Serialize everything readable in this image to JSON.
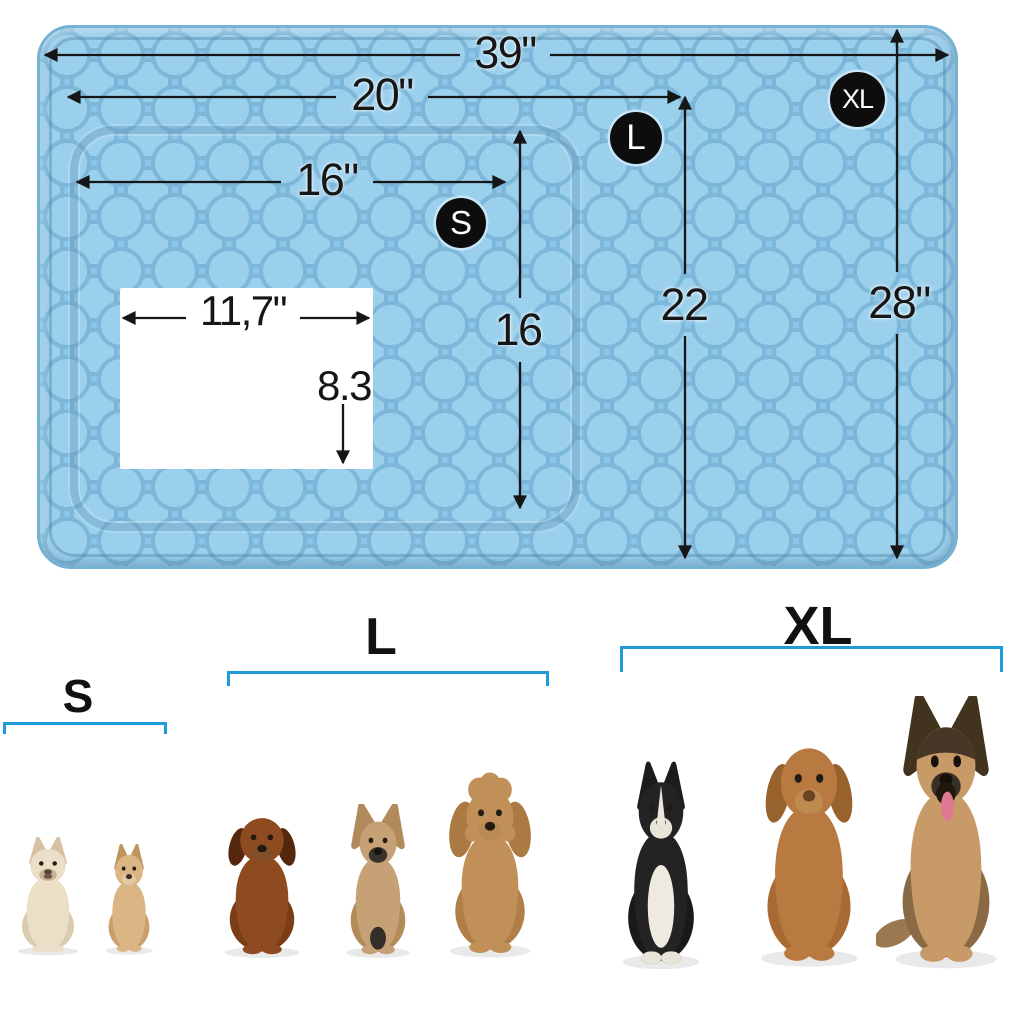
{
  "product": {
    "name": "pet cooling mat size chart"
  },
  "colors": {
    "mat_blue": "#8cc6e8",
    "mat_quilt_light": "#9bd0ed",
    "mat_quilt_shadow": "#7cb7da",
    "badge_black": "#0d0d0d",
    "badge_text": "#ffffff",
    "bracket_blue": "#1e9cd7",
    "dimension_black": "#161616",
    "window_white": "#ffffff"
  },
  "mat": {
    "badges": {
      "s": "S",
      "l": "L",
      "xl": "XL"
    },
    "dimensions": {
      "xl_width": "39\"",
      "l_width": "20\"",
      "s_width": "16\"",
      "s_height": "16",
      "l_height": "22",
      "xl_height": "28\"",
      "window_width": "11,7\"",
      "window_height": "8.3"
    }
  },
  "size_guide": {
    "groups": [
      {
        "id": "s",
        "label": "S",
        "dogs": [
          "chihuahua-cream",
          "chihuahua-tan"
        ]
      },
      {
        "id": "l",
        "label": "L",
        "dogs": [
          "dachshund",
          "french-bulldog",
          "poodle"
        ]
      },
      {
        "id": "xl",
        "label": "XL",
        "dogs": [
          "border-collie",
          "labrador-retriever",
          "german-shepherd"
        ]
      }
    ]
  }
}
